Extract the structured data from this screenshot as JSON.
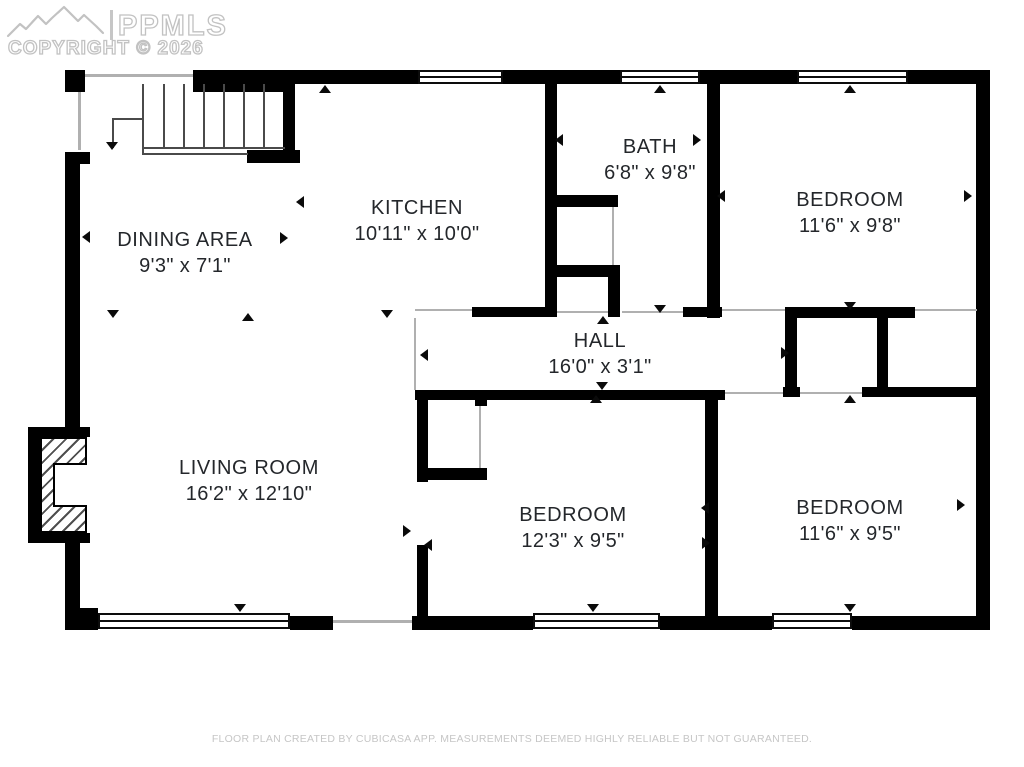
{
  "watermark": {
    "brand": "PPMLS",
    "copyright": "COPYRIGHT © 2026"
  },
  "rooms": [
    {
      "name": "DINING AREA",
      "dimensions": "9'3\" x 7'1\""
    },
    {
      "name": "KITCHEN",
      "dimensions": "10'11\" x 10'0\""
    },
    {
      "name": "BATH",
      "dimensions": "6'8\" x 9'8\""
    },
    {
      "name": "BEDROOM",
      "dimensions": "11'6\" x 9'8\""
    },
    {
      "name": "HALL",
      "dimensions": "16'0\" x 3'1\""
    },
    {
      "name": "LIVING ROOM",
      "dimensions": "16'2\" x 12'10\""
    },
    {
      "name": "BEDROOM",
      "dimensions": "12'3\" x 9'5\""
    },
    {
      "name": "BEDROOM",
      "dimensions": "11'6\" x 9'5\""
    }
  ],
  "footer": {
    "disclaimer": "FLOOR PLAN CREATED BY CUBICASA APP. MEASUREMENTS DEEMED HIGHLY RELIABLE BUT NOT GUARANTEED."
  },
  "colors": {
    "wall": "#000000",
    "watermark": "#c2c2c2",
    "room_label": "#24272b",
    "footer_text": "#c6c6c6"
  }
}
